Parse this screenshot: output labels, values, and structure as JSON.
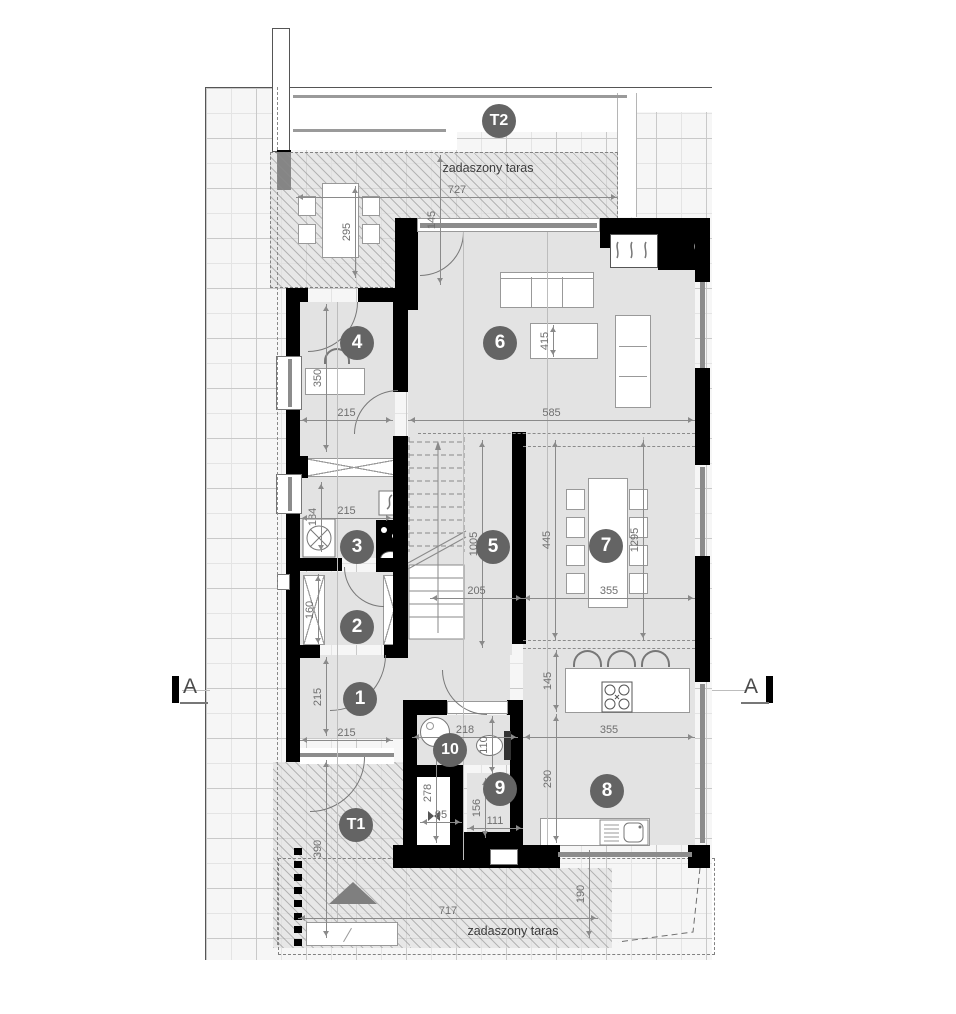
{
  "plan": {
    "terrace_top_label": "zadaszony taras",
    "terrace_bottom_label": "zadaszony taras",
    "section_marker_left": "A",
    "section_marker_right": "A",
    "room_markers": [
      {
        "id": "T2",
        "x": 499,
        "y": 121
      },
      {
        "id": "4",
        "x": 357,
        "y": 343
      },
      {
        "id": "6",
        "x": 500,
        "y": 343
      },
      {
        "id": "3",
        "x": 357,
        "y": 547
      },
      {
        "id": "5",
        "x": 493,
        "y": 547
      },
      {
        "id": "7",
        "x": 606,
        "y": 546
      },
      {
        "id": "2",
        "x": 357,
        "y": 627
      },
      {
        "id": "1",
        "x": 360,
        "y": 699
      },
      {
        "id": "10",
        "x": 450,
        "y": 750
      },
      {
        "id": "9",
        "x": 500,
        "y": 789
      },
      {
        "id": "8",
        "x": 607,
        "y": 791
      },
      {
        "id": "T1",
        "x": 356,
        "y": 825
      }
    ],
    "dimensions": [
      {
        "t": "727",
        "x1": 296,
        "y1": 197,
        "x2": 618,
        "y2": 197
      },
      {
        "t": "145",
        "x1": 440,
        "y1": 155,
        "x2": 440,
        "y2": 285
      },
      {
        "t": "295",
        "x1": 355,
        "y1": 186,
        "x2": 355,
        "y2": 278
      },
      {
        "t": "350",
        "x1": 326,
        "y1": 304,
        "x2": 326,
        "y2": 452
      },
      {
        "t": "215",
        "x1": 300,
        "y1": 420,
        "x2": 393,
        "y2": 420
      },
      {
        "t": "585",
        "x1": 408,
        "y1": 420,
        "x2": 695,
        "y2": 420
      },
      {
        "t": "415",
        "x1": 553,
        "y1": 325,
        "x2": 553,
        "y2": 357
      },
      {
        "t": "184",
        "x1": 321,
        "y1": 482,
        "x2": 321,
        "y2": 552
      },
      {
        "t": "215",
        "x1": 300,
        "y1": 518,
        "x2": 393,
        "y2": 518
      },
      {
        "t": "1005",
        "x1": 482,
        "y1": 440,
        "x2": 482,
        "y2": 648
      },
      {
        "t": "1295",
        "x1": 643,
        "y1": 440,
        "x2": 643,
        "y2": 640
      },
      {
        "t": "445",
        "x1": 555,
        "y1": 440,
        "x2": 555,
        "y2": 640
      },
      {
        "t": "355",
        "x1": 523,
        "y1": 598,
        "x2": 695,
        "y2": 598
      },
      {
        "t": "205",
        "x1": 430,
        "y1": 598,
        "x2": 523,
        "y2": 598
      },
      {
        "t": "160",
        "x1": 318,
        "y1": 574,
        "x2": 318,
        "y2": 645
      },
      {
        "t": "215",
        "x1": 326,
        "y1": 657,
        "x2": 326,
        "y2": 736
      },
      {
        "t": "215",
        "x1": 300,
        "y1": 740,
        "x2": 393,
        "y2": 740
      },
      {
        "t": "218",
        "x1": 412,
        "y1": 737,
        "x2": 518,
        "y2": 737
      },
      {
        "t": "110",
        "x1": 492,
        "y1": 716,
        "x2": 492,
        "y2": 774
      },
      {
        "t": "145",
        "x1": 556,
        "y1": 650,
        "x2": 556,
        "y2": 712
      },
      {
        "t": "355",
        "x1": 523,
        "y1": 737,
        "x2": 695,
        "y2": 737
      },
      {
        "t": "290",
        "x1": 556,
        "y1": 714,
        "x2": 556,
        "y2": 843
      },
      {
        "t": "278",
        "x1": 436,
        "y1": 742,
        "x2": 436,
        "y2": 843
      },
      {
        "t": "95",
        "x1": 420,
        "y1": 822,
        "x2": 462,
        "y2": 822
      },
      {
        "t": "156",
        "x1": 485,
        "y1": 778,
        "x2": 485,
        "y2": 838
      },
      {
        "t": "111",
        "x1": 467,
        "y1": 828,
        "x2": 523,
        "y2": 828
      },
      {
        "t": "390",
        "x1": 326,
        "y1": 760,
        "x2": 326,
        "y2": 938
      },
      {
        "t": "717",
        "x1": 298,
        "y1": 918,
        "x2": 598,
        "y2": 918
      },
      {
        "t": "190",
        "x1": 589,
        "y1": 850,
        "x2": 589,
        "y2": 938
      }
    ],
    "colors": {
      "wall": "#000000",
      "floor": "#e3e3e3",
      "marker": "#646464",
      "glazing": "#8c8c8c",
      "dimension_text": "#6f6f6f"
    }
  }
}
